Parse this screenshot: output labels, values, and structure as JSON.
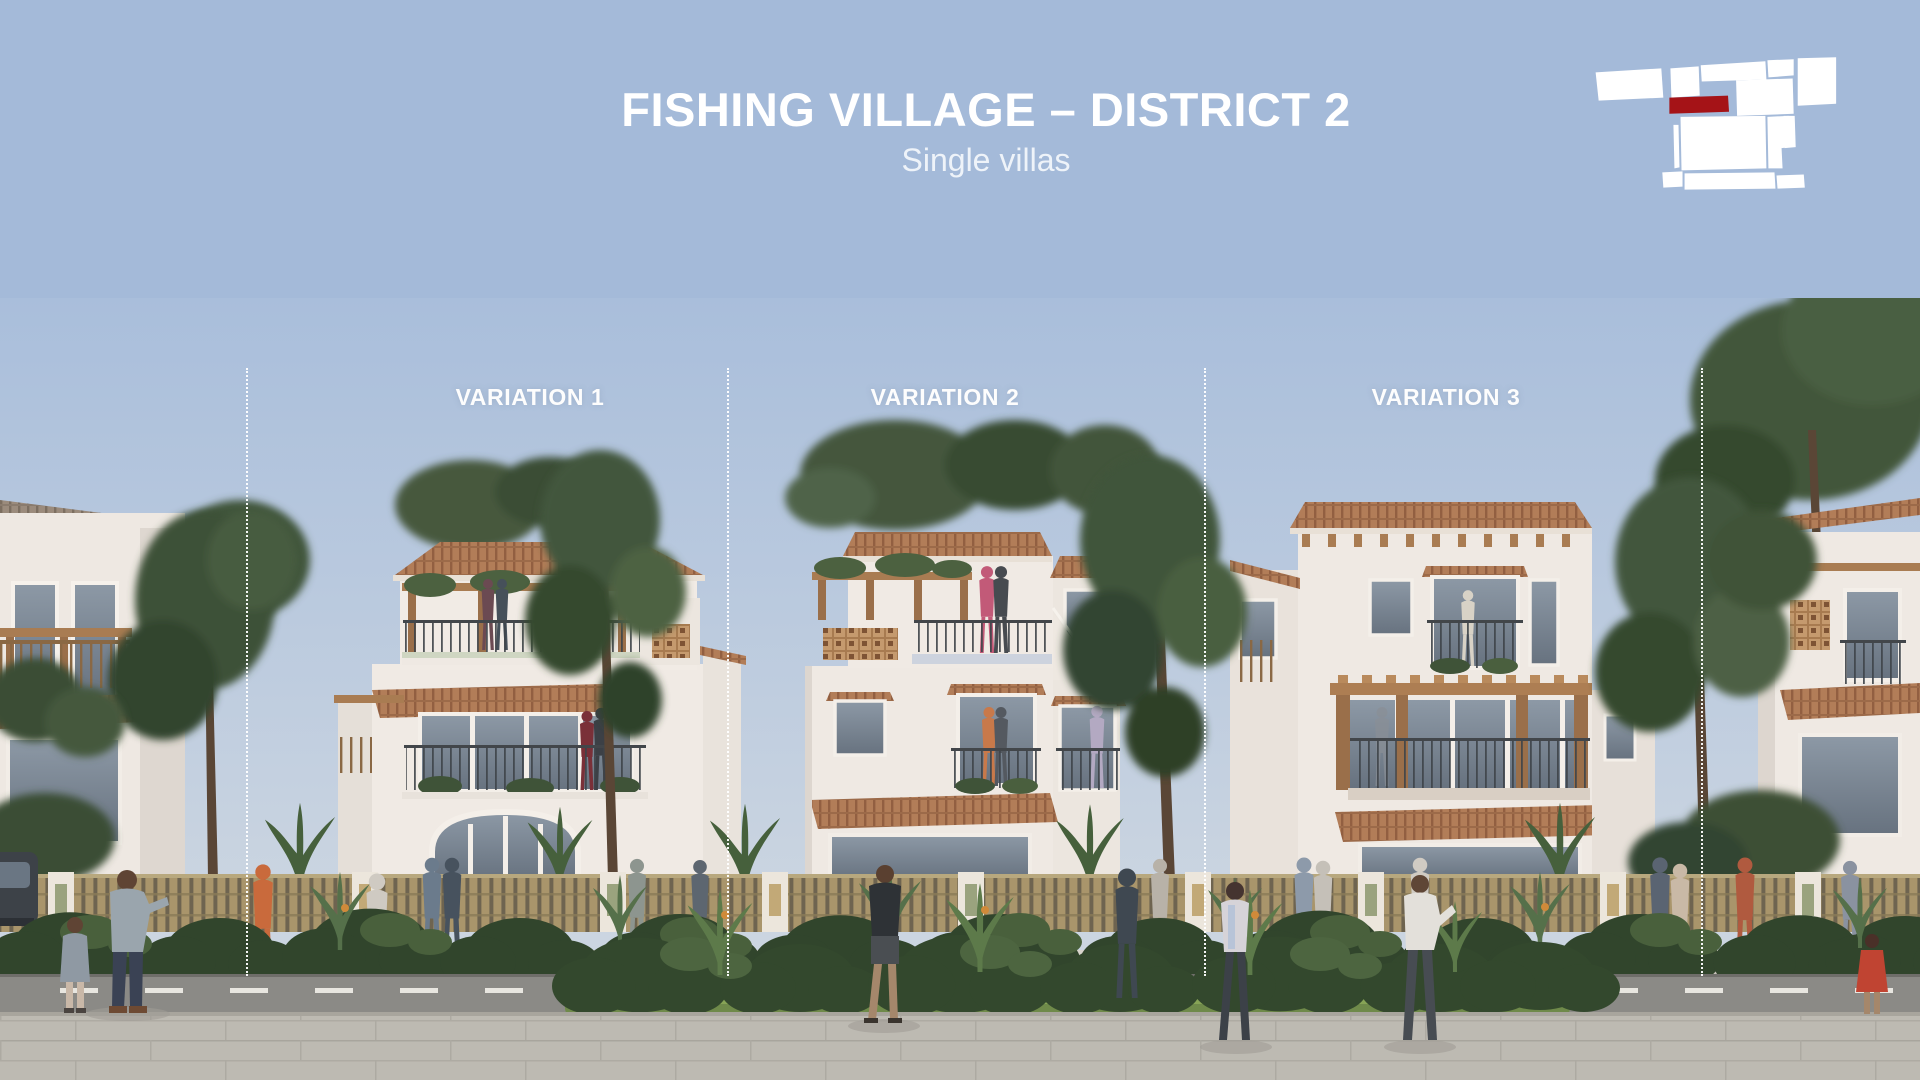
{
  "slide": {
    "title": "FISHING VILLAGE – DISTRICT 2",
    "subtitle": "Single villas"
  },
  "variations": [
    {
      "label": "VARIATION 1"
    },
    {
      "label": "VARIATION 2"
    },
    {
      "label": "VARIATION 3"
    }
  ],
  "logo": {
    "name": "site-plan-map-logo",
    "shape_color": "#ffffff",
    "highlight_color": "#a51317"
  },
  "scene": {
    "description": "Street elevation rendering of three Mediterranean single-villa facade variations with terracotta tile roofs, timber pergolas, balconies, slatted street fence, tropical planting, pedestrians, road and paved promenade",
    "colors": {
      "header_blue": "#a4bad9",
      "sky_top": "#a9bedb",
      "sky_horizon": "#cbd5e1",
      "wall_white": "#f0eae4",
      "roof_terracotta": "#b27d58",
      "pergola_wood": "#ab7c52",
      "fence_tan": "#a9956b",
      "foliage_green": "#41553b",
      "road_gray": "#8b8a86",
      "pavement_gray": "#bdbab2"
    }
  }
}
